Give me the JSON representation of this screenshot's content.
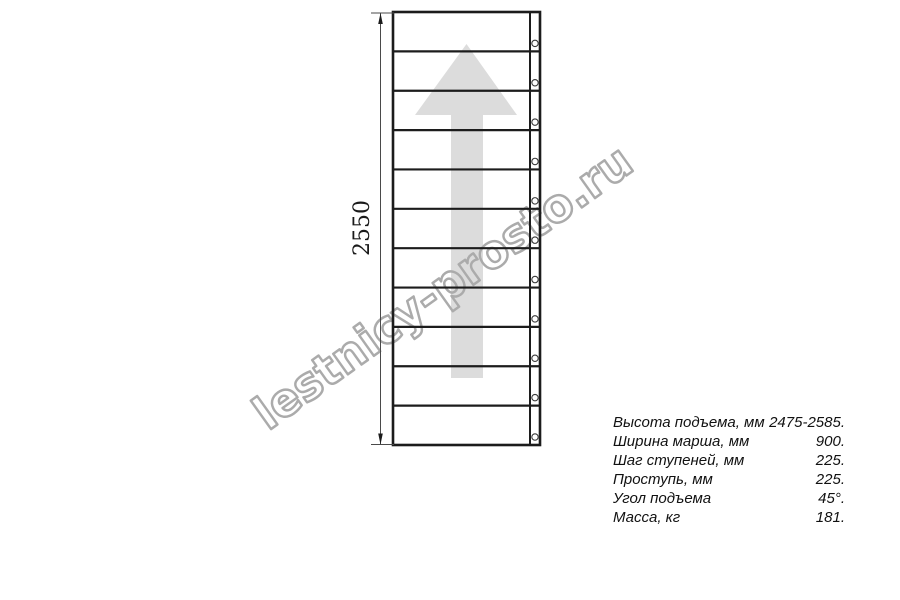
{
  "page": {
    "background": "#ffffff"
  },
  "drawing": {
    "type": "staircase-flight-top-view",
    "dimension_label": "2550",
    "steps_count": 11,
    "colors": {
      "line": "#1c1c1c",
      "arrow_fill": "#dcdcdc",
      "dimension": "#4a4a4a",
      "watermark": "#ababab",
      "hole_stroke": "#3a3a3a"
    }
  },
  "watermark": {
    "text": "lestnicy-prosto.ru"
  },
  "specs": {
    "rows": [
      {
        "label": "Высота подъема, мм",
        "value": "2475-2585."
      },
      {
        "label": "Ширина марша, мм",
        "value": "900."
      },
      {
        "label": "Шаг ступеней, мм",
        "value": "225."
      },
      {
        "label": "Проступь, мм",
        "value": "225."
      },
      {
        "label": "Угол подъема",
        "value": "45°."
      },
      {
        "label": "Масса, кг",
        "value": "181."
      }
    ]
  }
}
